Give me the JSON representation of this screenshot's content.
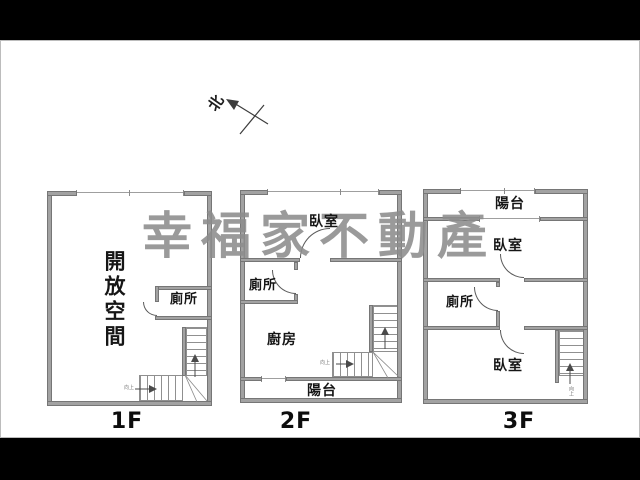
{
  "watermark": {
    "text": "幸福家不動產"
  },
  "compass": {
    "north": "北"
  },
  "colors": {
    "wall": "#a2a2a2",
    "watermark": "#8d8d8d",
    "line": "#5a5a5a"
  },
  "floor1": {
    "label": "1F",
    "open_space": "開放空間",
    "toilet": "廁所",
    "stairs_note": "向上"
  },
  "floor2": {
    "label": "2F",
    "bedroom": "臥室",
    "toilet": "廁所",
    "kitchen": "廚房",
    "balcony": "陽台",
    "stairs_note": "向上"
  },
  "floor3": {
    "label": "3F",
    "balcony": "陽台",
    "bedroom_top": "臥室",
    "toilet": "廁所",
    "bedroom_bottom": "臥室",
    "stairs_note": "向上"
  }
}
